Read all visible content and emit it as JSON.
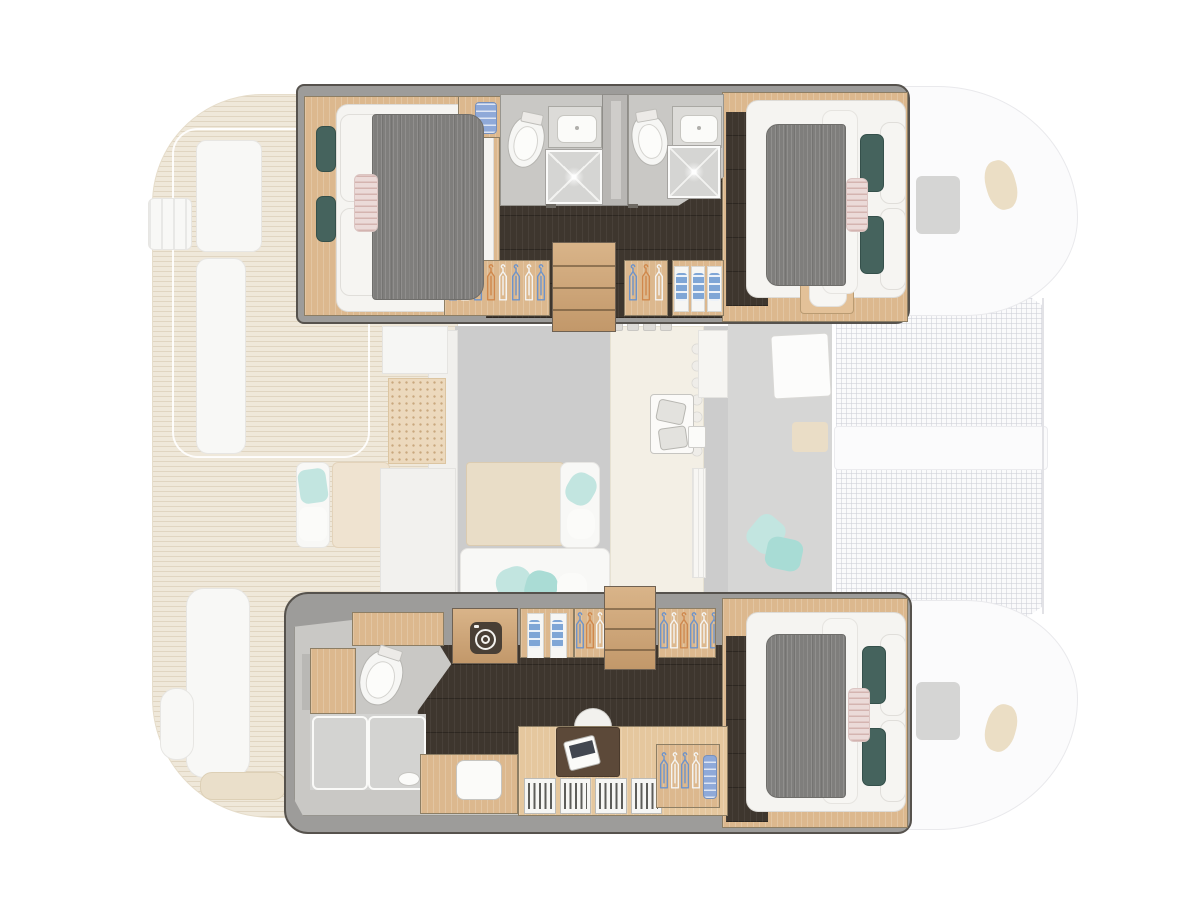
{
  "palette": {
    "background": "#ffffff",
    "hull_band": "#9d9c9a",
    "hull_outline": "#56524d",
    "interior_wood": "#dcb88e",
    "stair_wood": "#cfa87a",
    "dark_floor": "#3e362e",
    "bath_floor": "#c9c8c5",
    "shower_floor": "#d5d5d3",
    "duvet_grey": "#7f7e7c",
    "teal_pillow": "#45635d",
    "teal_cushion_faded": "#c2e5e0",
    "pink_pillow": "#ebdad8",
    "teak_deck": "#efe8da",
    "saloon_floor": "#cccccc",
    "galley_cream": "#f3efe5",
    "trampoline_mesh": "#fafafb",
    "washer_panel": "#493f35",
    "hanger_blue": "#6e93c9",
    "hanger_orange": "#d0884c",
    "hanger_white": "#f4f4f2",
    "clothes_blue": "#7fa6d6",
    "towel_blue": "#8fa9d8"
  },
  "icons": [
    "washing-machine-icon",
    "clothes-hanger-icon",
    "shower-sparkle-icon"
  ],
  "wardrobes": {
    "top_aft_hangers": [
      "blue",
      "white",
      "blue",
      "orange",
      "white",
      "blue",
      "white",
      "blue"
    ],
    "top_mid_hangers": [
      "blue",
      "orange",
      "white"
    ],
    "bottom_shelf_hangers": [
      "blue",
      "orange",
      "white",
      "blue"
    ],
    "bottom_fwd_hangers": [
      "blue",
      "white",
      "orange",
      "blue",
      "white",
      "blue"
    ],
    "bottom_desk_hangers": [
      "blue",
      "white",
      "blue",
      "white"
    ]
  },
  "storage": {
    "top_folded_stacks": 3,
    "bottom_folded_stacks": 2,
    "bookshelf_cells": 4
  },
  "stairs": {
    "top_steps": 4,
    "bottom_steps": 4
  },
  "galley": {
    "stool_tabs": 4
  }
}
